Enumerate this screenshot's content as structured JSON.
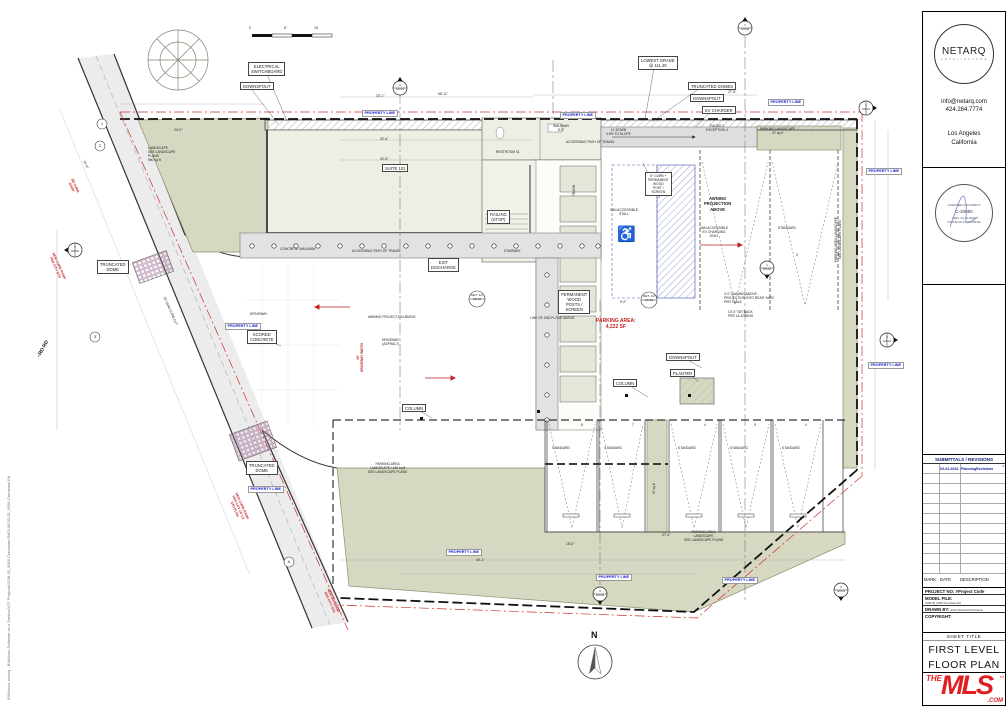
{
  "file_path": "BIMcloud: netarq - BIMcloud Software as a Service/V27 Projects/2108.00_5066 Crenshaw Rd/2108.00-05_5066 Crenshaw Rd",
  "title_block": {
    "logo_text": "NETARQ",
    "logo_sub": "A R C H I T E C T U R E",
    "email": "info@netarq.com",
    "phone": "424.284.7774",
    "city": "Los Angeles",
    "state": "California",
    "stamp_top": "LICENSED ARCHITECT",
    "stamp_license": "C-33080",
    "stamp_bottom": "STATE OF CALIFORNIA",
    "stamp_renew": "REN. 12-31-2023"
  },
  "submittals": {
    "header": "SUBMITTALS / REVISIONS",
    "rows": [
      {
        "date": "03-04-2024",
        "desc": "PlanningRevisions",
        "mark": "1"
      }
    ],
    "col_mark": "MARK",
    "col_date": "DATE",
    "col_desc": "DESCRIPTION"
  },
  "project_info": {
    "project_no": "PROJECT NO: #Project Code",
    "model_file_label": "MODEL FILE:",
    "model_file": "2108.00_5066 Crenshaw Rd",
    "drawn_by_label": "DRAWN BY:",
    "drawn_by": "#Ord Technical Full Name",
    "copyright": "COPYRIGHT:"
  },
  "sheet": {
    "label": "SHEET TITLE",
    "line1": "FIRST LEVEL",
    "line2": "FLOOR PLAN"
  },
  "mls": {
    "the": "THE",
    "mls": "MLS",
    "com": ".COM",
    "tm": "TM"
  },
  "plan": {
    "north": "N",
    "street": "~RD RD",
    "accessible_symbol": "wheelchair",
    "labels": {
      "electrical_switchboard": "ELECTRICAL\nSWITCHBOARD",
      "downspout": "DOWNSPOUT",
      "lowest_grade": "LOWEST GRADE\n@ 111.40",
      "truncated_domes": "TRUNCATED DOMES",
      "ev_charger": "EV CHARGER",
      "property_line": "PROPERTY LINE",
      "parking_landscape_37": "PARKING LANDSCAPE\n37 sq ft",
      "landscape_960": "LANDSCAPE\nSEE LANDSCAPE\nPLANS\n960 sq ft",
      "suite_101": "SUITE 101",
      "restroom_01": "RESTROOM 01",
      "walkway_8": "WALKWAY\n8'-0\"",
      "down_ramp": "11'   DOWN\n4.9% TO SLOPE",
      "accessible_path": "ACCESSIBLE PATH OF TRAVEL",
      "curb_screen": "6\" CURB +\nPERMANENT\nWOOD\nPOST /\nSCREEN",
      "awning_projection": "AWNING\nPROJECTION\nABOVE",
      "van_ev": "VAN ACCESSIBLE\nEV CHARGING\nONLY",
      "van_stall": "VAN ACCESSIBLE\nSTALL",
      "standard": "STANDARD",
      "trash": "TRASH",
      "railing_stop": "RAILING\n(STOP)",
      "stairway": "STAIRWAY",
      "exit_discharge": "EXIT\nDISCHARGE",
      "concrete_walkway": "CONCRETE WALKWAY",
      "driveway": "DRIVEWAY",
      "scored_concrete": "SCORED\nCONCRETE",
      "driveway_asphalt": "DRIVEWAY\n(ASPHALT)",
      "driveway_width": "26'\nDRIVEWAY WIDTH",
      "awning_projection_inline": "AWNING PROJECTION ABOVE",
      "permanent_wood": "PERMANENT\nWOOD\nPOSTS /\nSCREEN",
      "line_2nd_floor": "LINE OF 2ND FLOOR ABOVE",
      "parking_area": "PARKING AREA:\n4,222 SF",
      "planter": "PLANTER",
      "column": "COLUMN",
      "awning_note": "4'-0\" AWNING ABOVE :\nPROJECTION INTO REAR YARD\nPER TABLE",
      "setback_note": "10'-0\" SETBACK\nPER LA ZONING",
      "exception_note": "F/A 200.1\nEXCEPTION 4",
      "truncated_dome": "TRUNCATED\nDOME",
      "parking_landscape_vert": "PARKING AREA LANDSCAPE\nSEE LANDSCAPE PLANS",
      "parking_landscape_440": "PARKING AREA\nLANDSCAPE / 440 sq ft\nSEE LANDSCAPE PLANS",
      "parking_landscape_bottom": "PARKING AREA\nLANDSCAPE\nSEE LANDSCAPE PLANS",
      "sq27": "27 sq ft",
      "new_curb_cut": "18' NEW CURB CUT",
      "curb_ramp_note": "NEW CURB RAMP\nPER CITY STD",
      "curb_ramp_note2": "NEW CURB RAMP\nPER CITY OF LA\nSTD PLAN",
      "driveway_note": "NEW DRIVEWAY\nPER CITY STD",
      "existing_ramp": "(E) CURB\nRAMP"
    },
    "dims": {
      "d1": "33'-1\"",
      "d2": "66'-11\"",
      "d3": "32'-6\"",
      "d4": "32'-5\"",
      "d5": "27'-8\"",
      "d6": "24'-0\"",
      "d7": "34'-0\"",
      "d8": "18'-6\"",
      "d9": "47'-4\"",
      "d10": "40'-1\"",
      "d13": "9'-0\""
    },
    "scale": {
      "s0": "0",
      "s8": "8'",
      "s16": "16'"
    },
    "markers": {
      "m_a401": "1\nA4.01",
      "m_a402": "1\nA4.02",
      "m_a301": "1\nA3.01",
      "m_a302": "1\nA3.02",
      "m_a402b": "1\nA4.02",
      "m_a301b": "3\nA3.01",
      "m_a401b": "2\nA4.01",
      "m_a502": "1\nA5.02",
      "m_det": "DET. 1/2\nA5.12"
    },
    "grid": {
      "g1": "1",
      "g2": "2",
      "g3": "3",
      "g4": "A"
    },
    "counts": {
      "n8": "8",
      "n7": "7",
      "n4": "4",
      "n5": "5",
      "n4b": "4",
      "n3": "3"
    }
  }
}
